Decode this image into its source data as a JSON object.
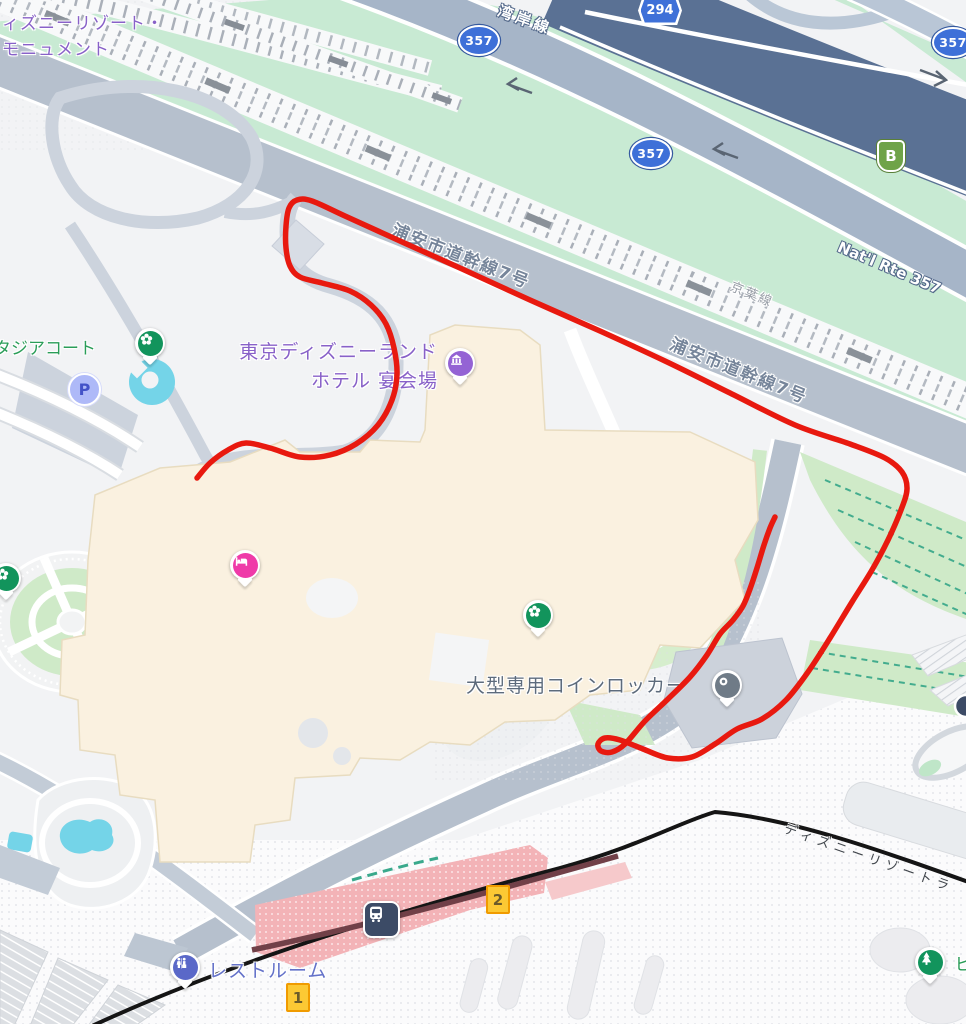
{
  "colors": {
    "annotation_red": "#e8190f",
    "expressway_navy": "#5a7194",
    "route_band_slate": "#a6b5c8",
    "road_gray": "#b6c0cd",
    "green_strip": "#c8ead3",
    "lawn_green": "#cfeac8",
    "water_cyan": "#74d4e8",
    "building_cream": "#faf1e0",
    "station_pink": "#f3b3b7",
    "rail_maroon": "#714048",
    "poi_purple": "#9463d4",
    "poi_pink": "#ef3aa8",
    "poi_park_green": "#12945c",
    "poi_gray": "#6f7b87",
    "poi_indigo": "#5a68c8",
    "label_purple": "#8861c8",
    "label_green": "#2a9d58",
    "label_road": "#76859a",
    "label_indigo": "#6472c9"
  },
  "labels": {
    "monument_line1": "ィズニーリゾート・",
    "monument_line2": "モニュメント",
    "stadia_court": "タジアコート",
    "hotel_line1": "東京ディズニーランド",
    "hotel_line2": "ホテル 宴会場",
    "wangan_line": "湾岸線",
    "keiyo_line": "京葉線",
    "natl_route": "Nat'l Rte 357",
    "urayasu_road": "浦安市道幹線7号",
    "coin_locker": "大型専用コインロッカー",
    "restroom": "レストルーム",
    "resort_line": "ディズニーリゾートラ",
    "partial_right_edge": "ビ"
  },
  "shields": {
    "national_route": "357",
    "prefectural_route": "294",
    "shuto_branch": "B"
  },
  "markers": {
    "parking": "P",
    "exit_1": "1",
    "exit_2": "2"
  },
  "annotation": {
    "color": "#e8190f",
    "width": 5.5,
    "points": [
      [
        197,
        478
      ],
      [
        210,
        463
      ],
      [
        228,
        450
      ],
      [
        246,
        443
      ],
      [
        270,
        448
      ],
      [
        300,
        457
      ],
      [
        330,
        455
      ],
      [
        356,
        444
      ],
      [
        378,
        425
      ],
      [
        392,
        400
      ],
      [
        397,
        374
      ],
      [
        394,
        348
      ],
      [
        386,
        324
      ],
      [
        371,
        305
      ],
      [
        350,
        291
      ],
      [
        322,
        283
      ],
      [
        300,
        277
      ],
      [
        290,
        266
      ],
      [
        286,
        248
      ],
      [
        286,
        226
      ],
      [
        289,
        208
      ],
      [
        297,
        200
      ],
      [
        312,
        201
      ],
      [
        345,
        216
      ],
      [
        400,
        241
      ],
      [
        460,
        268
      ],
      [
        530,
        300
      ],
      [
        600,
        331
      ],
      [
        665,
        361
      ],
      [
        730,
        393
      ],
      [
        795,
        425
      ],
      [
        850,
        444
      ],
      [
        885,
        458
      ],
      [
        902,
        472
      ],
      [
        907,
        489
      ],
      [
        901,
        510
      ],
      [
        888,
        540
      ],
      [
        872,
        570
      ],
      [
        852,
        602
      ],
      [
        830,
        638
      ],
      [
        808,
        672
      ],
      [
        786,
        700
      ],
      [
        762,
        719
      ],
      [
        737,
        729
      ],
      [
        715,
        744
      ],
      [
        692,
        757
      ],
      [
        668,
        758
      ],
      [
        643,
        749
      ],
      [
        620,
        740
      ],
      [
        605,
        738
      ],
      [
        598,
        744
      ],
      [
        601,
        751
      ],
      [
        612,
        752
      ],
      [
        625,
        744
      ],
      [
        645,
        721
      ],
      [
        668,
        699
      ],
      [
        690,
        677
      ],
      [
        707,
        655
      ],
      [
        720,
        634
      ],
      [
        733,
        620
      ],
      [
        743,
        606
      ],
      [
        750,
        589
      ],
      [
        757,
        568
      ],
      [
        764,
        545
      ],
      [
        770,
        528
      ],
      [
        775,
        517
      ]
    ]
  }
}
